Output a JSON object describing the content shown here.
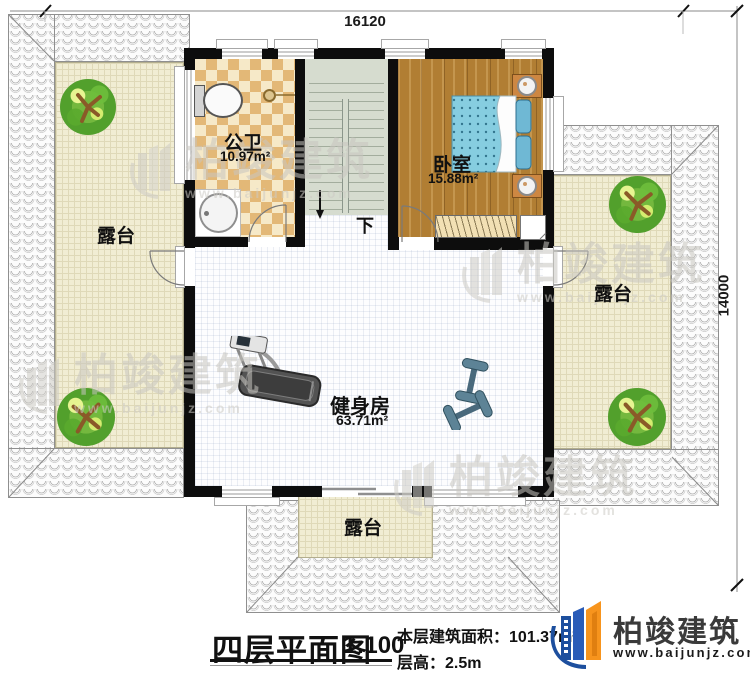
{
  "dimensions": {
    "width": "16120",
    "height": "14000"
  },
  "rooms": {
    "bathroom": {
      "name": "公卫",
      "area": "10.97m²"
    },
    "bedroom": {
      "name": "卧室",
      "area": "15.88m²"
    },
    "gym": {
      "name": "健身房",
      "area": "63.71m²"
    }
  },
  "terraces": {
    "left": "露台",
    "right": "露台",
    "bottom": "露台"
  },
  "stairs": {
    "direction": "下"
  },
  "title_block": {
    "title": "四层平面图",
    "scale": "1:100",
    "area_label": "本层建筑面积：",
    "area_value": "101.37m²",
    "height_label": "层高：",
    "height_value": "2.5m"
  },
  "logo": {
    "name": "柏竣建筑",
    "website": "www.baijunjz.com"
  },
  "watermark": {
    "text": "柏竣建筑",
    "url": "www.baijunjz.com"
  },
  "colors": {
    "brand_blue": "#1d4f9e",
    "brand_orange": "#f7941d",
    "wall": "#0d0d0d",
    "wood": "#b17e33",
    "mattress": "#86cde0",
    "terrace": "#f1edd3",
    "stair": "#d6dccf"
  }
}
